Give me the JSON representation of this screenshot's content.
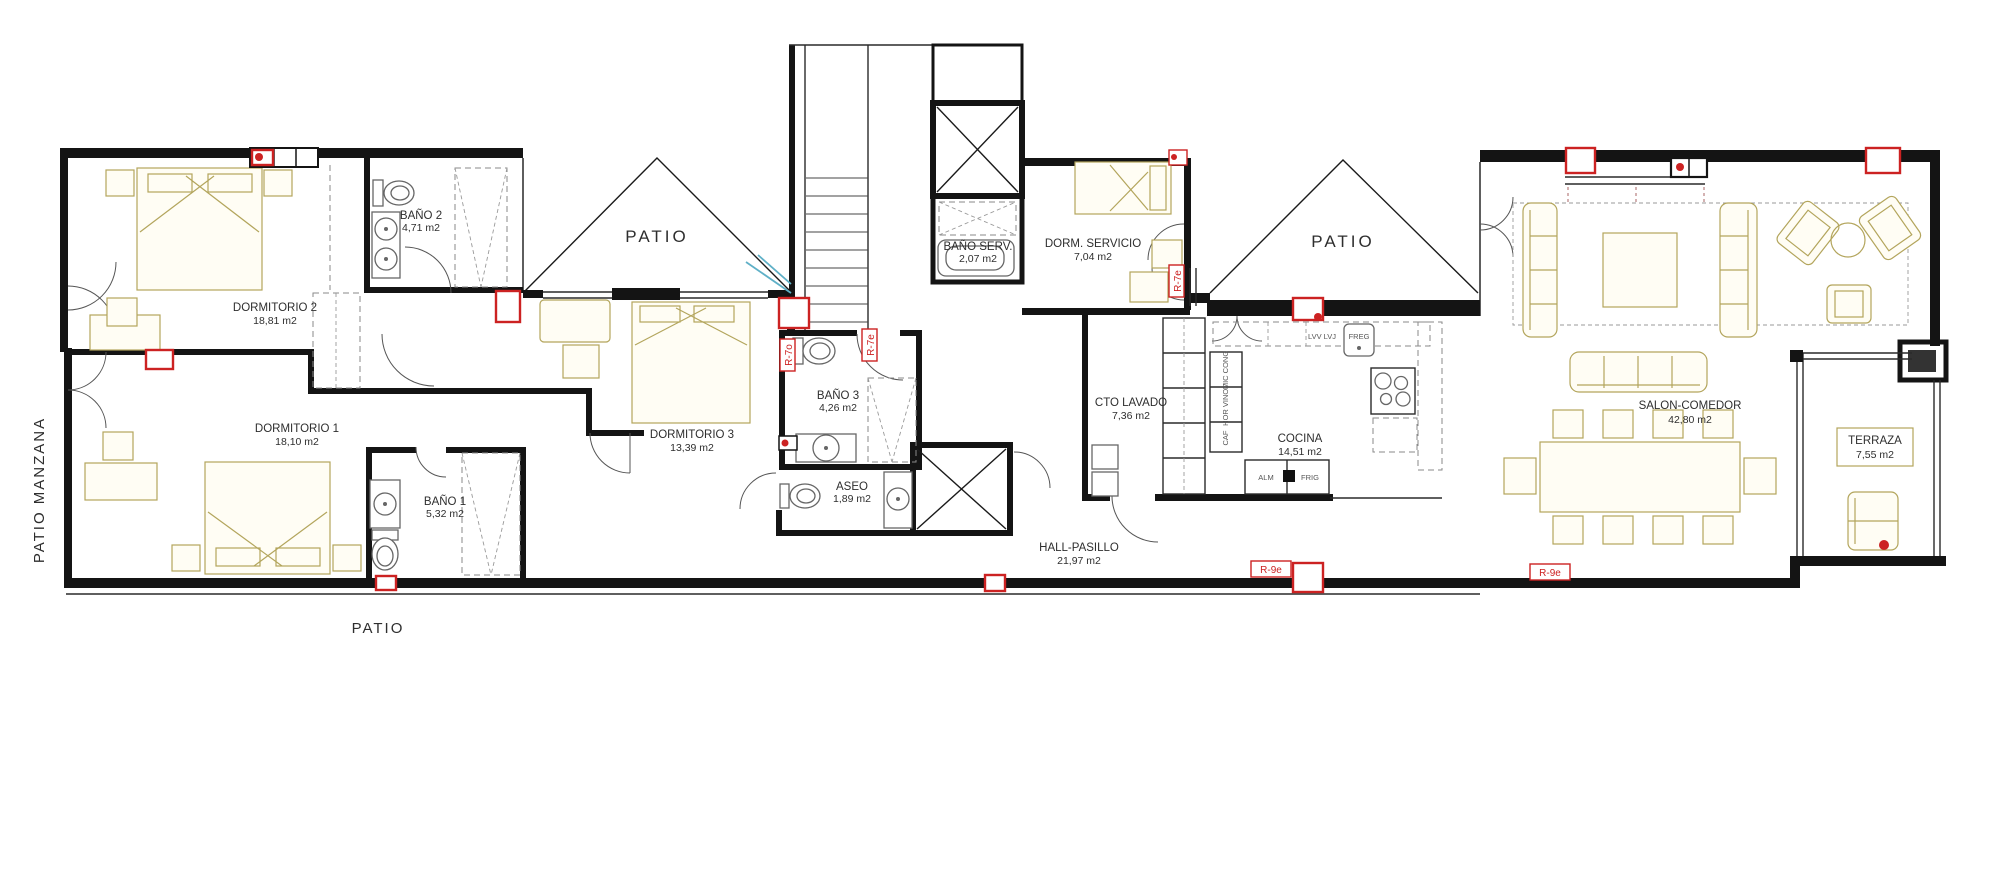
{
  "colors": {
    "wall": "#141414",
    "furniture_accent": "#b3a55c",
    "marker_red": "#cc2222",
    "stair_arrow": "#5fb0c7"
  },
  "rooms": {
    "dormitorio2": {
      "name": "DORMITORIO 2",
      "area": "18,81 m2"
    },
    "bano2": {
      "name": "BAÑO 2",
      "area": "4,71 m2"
    },
    "dormitorio1": {
      "name": "DORMITORIO 1",
      "area": "18,10 m2"
    },
    "bano1": {
      "name": "BAÑO 1",
      "area": "5,32 m2"
    },
    "dormitorio3": {
      "name": "DORMITORIO 3",
      "area": "13,39 m2"
    },
    "bano3": {
      "name": "BAÑO 3",
      "area": "4,26 m2"
    },
    "aseo": {
      "name": "ASEO",
      "area": "1,89 m2"
    },
    "bano_servicio": {
      "name": "BAÑO SERV.",
      "area": "2,07 m2"
    },
    "dorm_servicio": {
      "name": "DORM. SERVICIO",
      "area": "7,04 m2"
    },
    "cto_lavado": {
      "name": "CTO LAVADO",
      "area": "7,36 m2"
    },
    "cocina": {
      "name": "COCINA",
      "area": "14,51 m2"
    },
    "salon_comedor": {
      "name": "SALON-COMEDOR",
      "area": "42,80 m2"
    },
    "terraza": {
      "name": "TERRAZA",
      "area": "7,55 m2"
    },
    "hall_pasillo": {
      "name": "HALL-PASILLO",
      "area": "21,97 m2"
    }
  },
  "outdoor": {
    "patio_manzana": "PATIO MANZANA",
    "patio_left": "PATIO",
    "patio_triangle_1": "PATIO",
    "patio_triangle_2": "PATIO"
  },
  "markers": {
    "r7o": "R-7o",
    "r7e_bano3": "R-7e",
    "r7e_dorm_servicio": "R-7e",
    "r9e_1": "R-9e",
    "r9e_2": "R-9e"
  },
  "kitchen": {
    "mic_cong": "MIC CONG",
    "hor_vinot": "HOR VINOT",
    "caf": "CAF",
    "alm": "ALM",
    "frig": "FRIG",
    "freg": "FREG",
    "lvv_lvj": "LVV LVJ"
  }
}
